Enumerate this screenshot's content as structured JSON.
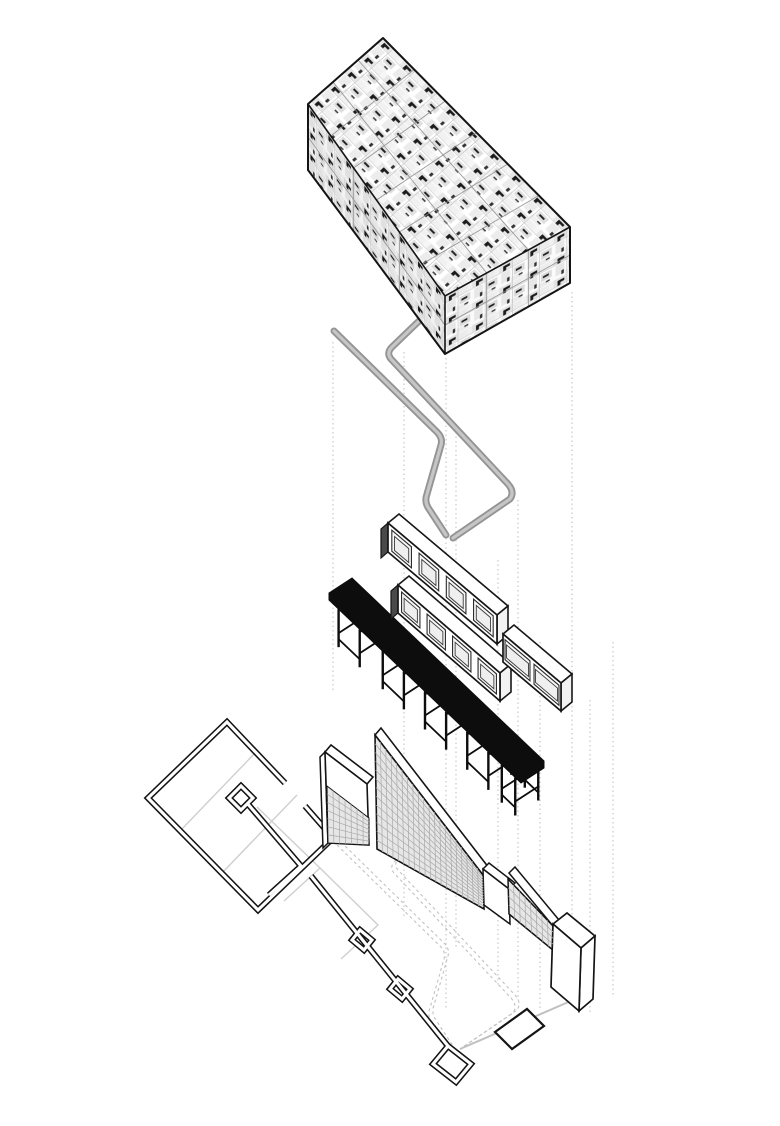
{
  "artwork": {
    "type": "Exploded axonometric architectural diagram",
    "description": "Vertically exploded drawing of a bar interior: collaged ceiling volume, bent handrail tube, hung wall cabinets, black bar counter on trestle legs, tiled partition walls and the floor plan, linked by dotted projection lines.",
    "layers": [
      {
        "name": "collage-box",
        "label": "Collaged box volume"
      },
      {
        "name": "rail-tube",
        "label": "Bent gray handrail tube"
      },
      {
        "name": "wall-cabinets",
        "label": "Paneled wall cabinets"
      },
      {
        "name": "bar-counter",
        "label": "Black bar counter with trestle legs"
      },
      {
        "name": "tiled-walls",
        "label": "Tiled partition walls and white column"
      },
      {
        "name": "floor-plan",
        "label": "Floor plan with double-line walls"
      }
    ],
    "cabinets": {
      "panel_counts": [
        4,
        4,
        2
      ]
    }
  },
  "colors": {
    "paper": "#ffffff",
    "ink": "#141414",
    "bar_black": "#0d0d0d",
    "tube_outer": "#949494",
    "tube_inner": "#c6c6c6",
    "grid_line": "#a8a8a8",
    "grid_fill": "#e6e6e6",
    "dotted_guide": "#c4c4c4",
    "dashed_projection": "#c2c2c2",
    "partition_gray": "#cfcfcf",
    "platform_gray": "#c0c0c0",
    "seam_gray": "#8a8a8a"
  }
}
